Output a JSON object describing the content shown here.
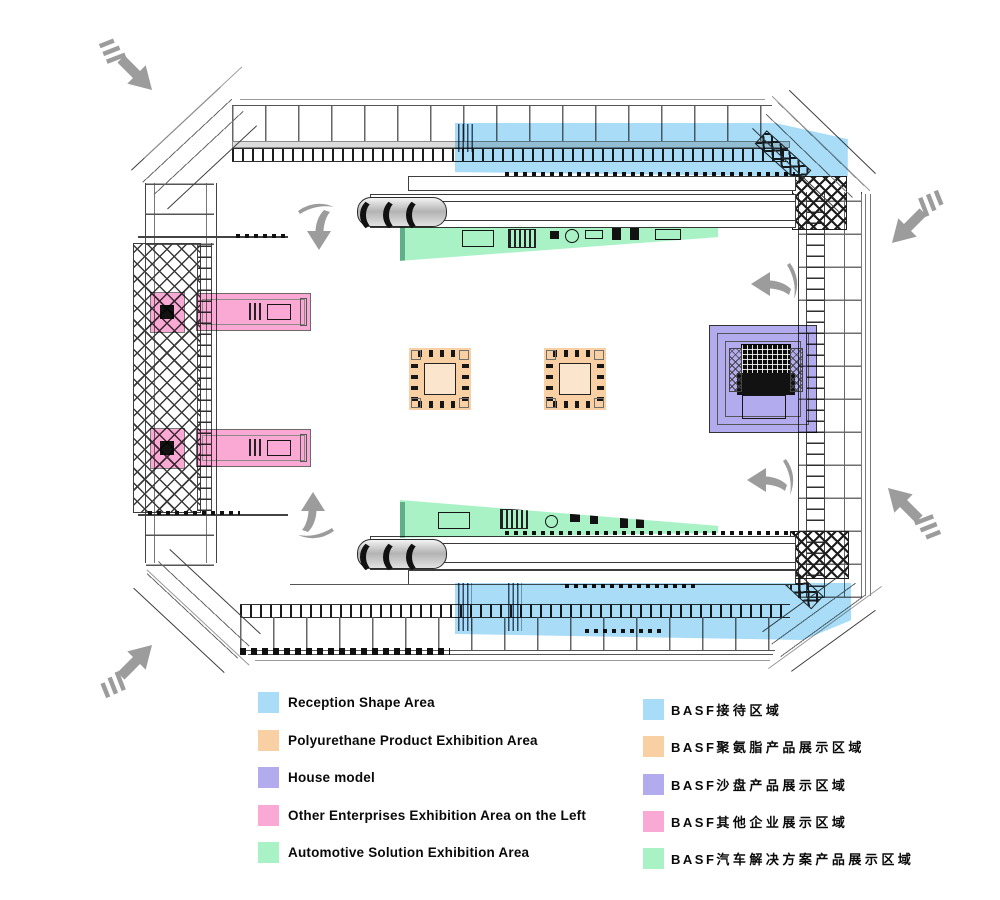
{
  "colors": {
    "reception_blue": "#A9DCF6",
    "polyurethane_orange": "#F9CFA4",
    "house_purple": "#B2ABEE",
    "other_pink": "#FAA9D4",
    "automotive_green": "#A9F2C5",
    "arrow_gray": "#9C9C9C"
  },
  "legend_en": {
    "items": [
      {
        "key": "reception",
        "label": "Reception Shape Area"
      },
      {
        "key": "polyurethane",
        "label": "Polyurethane Product Exhibition Area"
      },
      {
        "key": "house",
        "label": "House model"
      },
      {
        "key": "other",
        "label": "Other Enterprises Exhibition Area on the Left"
      },
      {
        "key": "automotive",
        "label": "Automotive Solution Exhibition Area"
      }
    ]
  },
  "legend_zh": {
    "items": [
      {
        "key": "reception",
        "prefix": "BASF",
        "label": "接待区域"
      },
      {
        "key": "polyurethane",
        "prefix": "BASF",
        "label": "聚氨脂产品展示区域"
      },
      {
        "key": "house",
        "prefix": "BASF",
        "label": "沙盘产品展示区域"
      },
      {
        "key": "other",
        "prefix": "BASF",
        "label": "其他企业展示区域"
      },
      {
        "key": "automotive",
        "prefix": "BASF",
        "label": "汽车解决方案产品展示区域"
      }
    ]
  }
}
